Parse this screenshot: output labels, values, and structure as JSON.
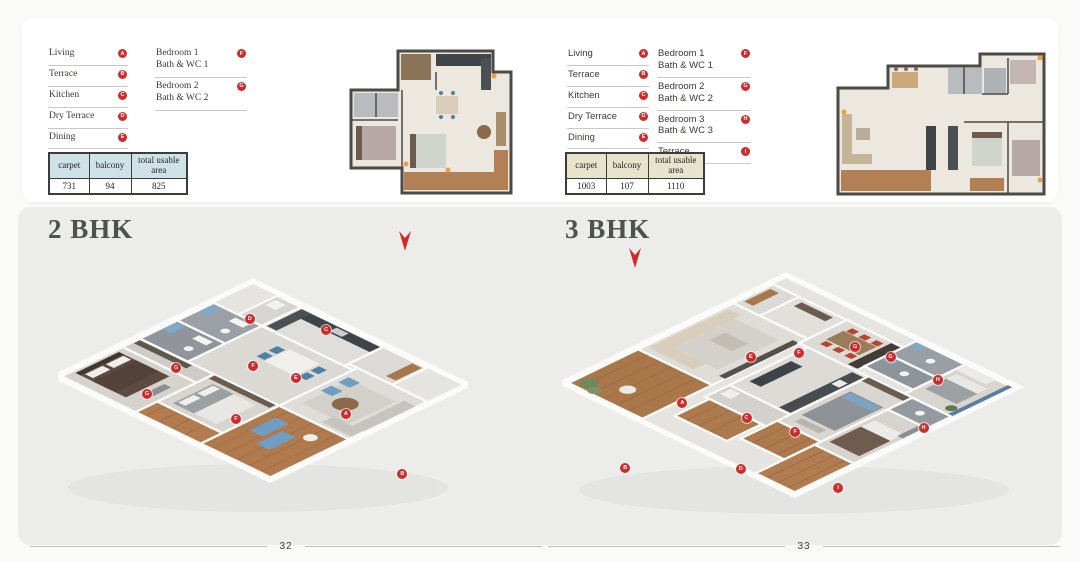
{
  "colors": {
    "accent_red": "#cf2b2a",
    "heading": "#4d5349",
    "panel_bg": "#ecedeb",
    "table_header_bg_left": "#cfe2e8",
    "table_header_bg_right": "#e9e2cd"
  },
  "pages": [
    {
      "heading": "2 BHK",
      "page_number": "32",
      "table_header_bg": "#cfe2e8",
      "legend_rooms": [
        {
          "label": "Living",
          "marker": "A"
        },
        {
          "label": "Terrace",
          "marker": "B"
        },
        {
          "label": "Kitchen",
          "marker": "C"
        },
        {
          "label": "Dry Terrace",
          "marker": "D"
        },
        {
          "label": "Dining",
          "marker": "E"
        }
      ],
      "legend_bedrooms": [
        {
          "line1": "Bedroom 1",
          "line2": "Bath & WC 1",
          "marker": "F"
        },
        {
          "line1": "Bedroom 2",
          "line2": "Bath & WC 2",
          "marker": "G"
        }
      ],
      "legend_extra": [],
      "area_table": {
        "headers": [
          "carpet",
          "balcony",
          "total usable area"
        ],
        "values": [
          "731",
          "94",
          "825"
        ]
      },
      "plan_markers": [
        {
          "label": "D",
          "x": 46.8,
          "y": 25.2
        },
        {
          "label": "C",
          "x": 65.4,
          "y": 29.0
        },
        {
          "label": "G",
          "x": 28.8,
          "y": 42.0
        },
        {
          "label": "F",
          "x": 47.6,
          "y": 41.4
        },
        {
          "label": "E",
          "x": 58.0,
          "y": 45.5
        },
        {
          "label": "A",
          "x": 70.2,
          "y": 58.0
        },
        {
          "label": "G",
          "x": 21.7,
          "y": 51.0
        },
        {
          "label": "F",
          "x": 43.4,
          "y": 59.7
        },
        {
          "label": "B",
          "x": 84.0,
          "y": 78.6
        }
      ]
    },
    {
      "heading": "3 BHK",
      "page_number": "33",
      "table_header_bg": "#e9e2cd",
      "legend_rooms": [
        {
          "label": "Living",
          "marker": "A"
        },
        {
          "label": "Terrace",
          "marker": "B"
        },
        {
          "label": "Kitchen",
          "marker": "C"
        },
        {
          "label": "Dry Terrace",
          "marker": "D"
        },
        {
          "label": "Dining",
          "marker": "E"
        }
      ],
      "legend_bedrooms": [
        {
          "line1": "Bedroom 1",
          "line2": "Bath & WC 1",
          "marker": "F"
        },
        {
          "line1": "Bedroom 2",
          "line2": "Bath & WC 2",
          "marker": "G"
        },
        {
          "line1": "Bedroom 3",
          "line2": "Bath & WC 3",
          "marker": "H"
        }
      ],
      "legend_extra": [
        {
          "label": "Terrace",
          "marker": "I"
        }
      ],
      "area_table": {
        "headers": [
          "carpet",
          "balcony",
          "total usable area"
        ],
        "values": [
          "1003",
          "107",
          "1110"
        ]
      },
      "plan_markers": [
        {
          "label": "E",
          "x": 40.0,
          "y": 38.6
        },
        {
          "label": "F",
          "x": 50.2,
          "y": 37.2
        },
        {
          "label": "G",
          "x": 62.1,
          "y": 35.2
        },
        {
          "label": "G",
          "x": 69.6,
          "y": 38.6
        },
        {
          "label": "H",
          "x": 79.6,
          "y": 46.6
        },
        {
          "label": "A",
          "x": 25.5,
          "y": 54.5
        },
        {
          "label": "C",
          "x": 39.1,
          "y": 59.7
        },
        {
          "label": "F",
          "x": 49.4,
          "y": 64.5
        },
        {
          "label": "H",
          "x": 76.6,
          "y": 63.1
        },
        {
          "label": "B",
          "x": 13.4,
          "y": 76.6
        },
        {
          "label": "D",
          "x": 37.9,
          "y": 77.2
        },
        {
          "label": "I",
          "x": 58.5,
          "y": 83.4
        }
      ]
    }
  ]
}
